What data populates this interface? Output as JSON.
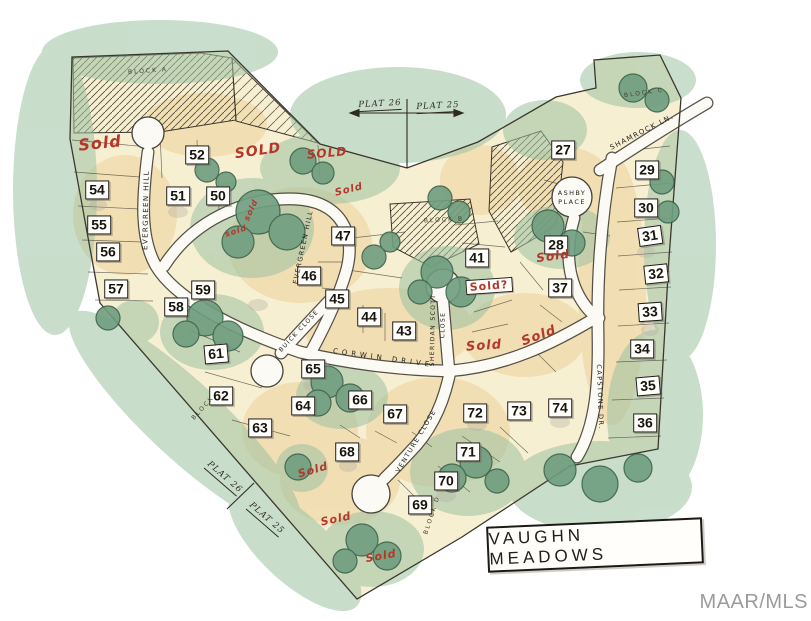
{
  "map": {
    "title_box": {
      "label": "VAUGHN MEADOWS"
    },
    "watermark": {
      "label": "MAAR/MLS"
    },
    "colors": {
      "sold_red": "#b5372a",
      "tree_green": "#6f9e7f",
      "paper_cream": "#f7efd2",
      "road_white": "#fbfaf5",
      "ink": "#3b372e"
    },
    "lots": [
      {
        "num": "27",
        "x": 563,
        "y": 150
      },
      {
        "num": "28",
        "x": 556,
        "y": 245
      },
      {
        "num": "29",
        "x": 647,
        "y": 170
      },
      {
        "num": "30",
        "x": 646,
        "y": 208
      },
      {
        "num": "31",
        "x": 650,
        "y": 236,
        "rot": -8
      },
      {
        "num": "32",
        "x": 656,
        "y": 274,
        "rot": -6
      },
      {
        "num": "33",
        "x": 650,
        "y": 312,
        "rot": -4
      },
      {
        "num": "34",
        "x": 642,
        "y": 349
      },
      {
        "num": "35",
        "x": 648,
        "y": 386,
        "rot": -5
      },
      {
        "num": "36",
        "x": 645,
        "y": 423
      },
      {
        "num": "37",
        "x": 560,
        "y": 288
      },
      {
        "num": "41",
        "x": 477,
        "y": 258
      },
      {
        "num": "43",
        "x": 404,
        "y": 331
      },
      {
        "num": "44",
        "x": 369,
        "y": 317
      },
      {
        "num": "45",
        "x": 337,
        "y": 299
      },
      {
        "num": "46",
        "x": 309,
        "y": 276
      },
      {
        "num": "47",
        "x": 343,
        "y": 236
      },
      {
        "num": "50",
        "x": 218,
        "y": 196
      },
      {
        "num": "51",
        "x": 178,
        "y": 196
      },
      {
        "num": "52",
        "x": 197,
        "y": 155
      },
      {
        "num": "54",
        "x": 97,
        "y": 190
      },
      {
        "num": "55",
        "x": 99,
        "y": 225
      },
      {
        "num": "56",
        "x": 108,
        "y": 252
      },
      {
        "num": "57",
        "x": 116,
        "y": 289
      },
      {
        "num": "58",
        "x": 176,
        "y": 307
      },
      {
        "num": "59",
        "x": 203,
        "y": 290
      },
      {
        "num": "61",
        "x": 216,
        "y": 354,
        "rot": -5
      },
      {
        "num": "62",
        "x": 221,
        "y": 396
      },
      {
        "num": "63",
        "x": 260,
        "y": 428
      },
      {
        "num": "64",
        "x": 303,
        "y": 406
      },
      {
        "num": "65",
        "x": 313,
        "y": 369
      },
      {
        "num": "66",
        "x": 360,
        "y": 400
      },
      {
        "num": "67",
        "x": 395,
        "y": 414
      },
      {
        "num": "68",
        "x": 347,
        "y": 452
      },
      {
        "num": "69",
        "x": 420,
        "y": 505
      },
      {
        "num": "70",
        "x": 446,
        "y": 481
      },
      {
        "num": "71",
        "x": 468,
        "y": 452
      },
      {
        "num": "72",
        "x": 475,
        "y": 413
      },
      {
        "num": "73",
        "x": 519,
        "y": 411
      },
      {
        "num": "74",
        "x": 560,
        "y": 408
      }
    ],
    "streets": [
      {
        "text": "EVERGREEN HILL",
        "x": 146,
        "y": 210,
        "rot": -89
      },
      {
        "text": "EVERGREEN HILL",
        "x": 303,
        "y": 247,
        "rot": -78,
        "size": 6.5
      },
      {
        "text": "SHAMROCK LN.",
        "x": 642,
        "y": 132,
        "rot": -27
      },
      {
        "text": "ASHBY",
        "x": 572,
        "y": 193,
        "rot": 0,
        "size": 6.5
      },
      {
        "text": "PLACE",
        "x": 572,
        "y": 202,
        "rot": 0,
        "size": 6.5
      },
      {
        "text": "CORWIN DRIVE",
        "x": 383,
        "y": 358,
        "rot": 8,
        "ls": 4
      },
      {
        "text": "SHERIDAN SCOTT",
        "x": 433,
        "y": 330,
        "rot": -89,
        "size": 6
      },
      {
        "text": "CLOSE",
        "x": 443,
        "y": 325,
        "rot": -89,
        "size": 6
      },
      {
        "text": "CAPSTONE DR.",
        "x": 600,
        "y": 397,
        "rot": 88,
        "size": 6.5
      },
      {
        "text": "BUICK CLOSE",
        "x": 299,
        "y": 331,
        "rot": -47,
        "size": 6
      },
      {
        "text": "VENTURE CLOSE",
        "x": 416,
        "y": 441,
        "rot": -59,
        "size": 6.5
      }
    ],
    "blocks": [
      {
        "text": "BLOCK A",
        "x": 148,
        "y": 71,
        "rot": -4
      },
      {
        "text": "BLOCK B",
        "x": 444,
        "y": 220,
        "rot": -3
      },
      {
        "text": "BLOCK C",
        "x": 644,
        "y": 93,
        "rot": -8
      },
      {
        "text": "BLOCK D",
        "x": 432,
        "y": 515,
        "rot": -72
      },
      {
        "text": "BLOCK",
        "x": 203,
        "y": 408,
        "rot": -48
      }
    ],
    "sold_annotations": [
      {
        "text": "Sold",
        "x": 100,
        "y": 143,
        "rot": -6,
        "size": 16
      },
      {
        "text": "SOLD",
        "x": 258,
        "y": 151,
        "rot": -8,
        "size": 14
      },
      {
        "text": "SOLD",
        "x": 327,
        "y": 153,
        "rot": -5,
        "size": 12
      },
      {
        "text": "Sold",
        "x": 349,
        "y": 190,
        "rot": -14,
        "size": 10
      },
      {
        "text": "sold",
        "x": 251,
        "y": 210,
        "rot": -65,
        "size": 8
      },
      {
        "text": "sold",
        "x": 236,
        "y": 231,
        "rot": -18,
        "size": 8
      },
      {
        "text": "Sold?",
        "x": 489,
        "y": 286,
        "rot": -4,
        "size": 11,
        "boxed": true
      },
      {
        "text": "Sold",
        "x": 553,
        "y": 256,
        "rot": -8,
        "size": 12
      },
      {
        "text": "Sold",
        "x": 484,
        "y": 346,
        "rot": -4,
        "size": 13
      },
      {
        "text": "Sold",
        "x": 539,
        "y": 336,
        "rot": -20,
        "size": 13
      },
      {
        "text": "Sold",
        "x": 313,
        "y": 470,
        "rot": -16,
        "size": 11
      },
      {
        "text": "Sold",
        "x": 336,
        "y": 519,
        "rot": -12,
        "size": 11
      },
      {
        "text": "Sold",
        "x": 381,
        "y": 556,
        "rot": -10,
        "size": 11
      }
    ],
    "plat_boundary_labels": [
      {
        "text": "PLAT 26",
        "x": 380,
        "y": 105,
        "rot": -3
      },
      {
        "text": "PLAT 25",
        "x": 438,
        "y": 107,
        "rot": -3
      },
      {
        "text": "PLAT 26",
        "x": 224,
        "y": 478,
        "rot": 41
      },
      {
        "text": "PLAT 25",
        "x": 266,
        "y": 519,
        "rot": 41
      }
    ]
  }
}
